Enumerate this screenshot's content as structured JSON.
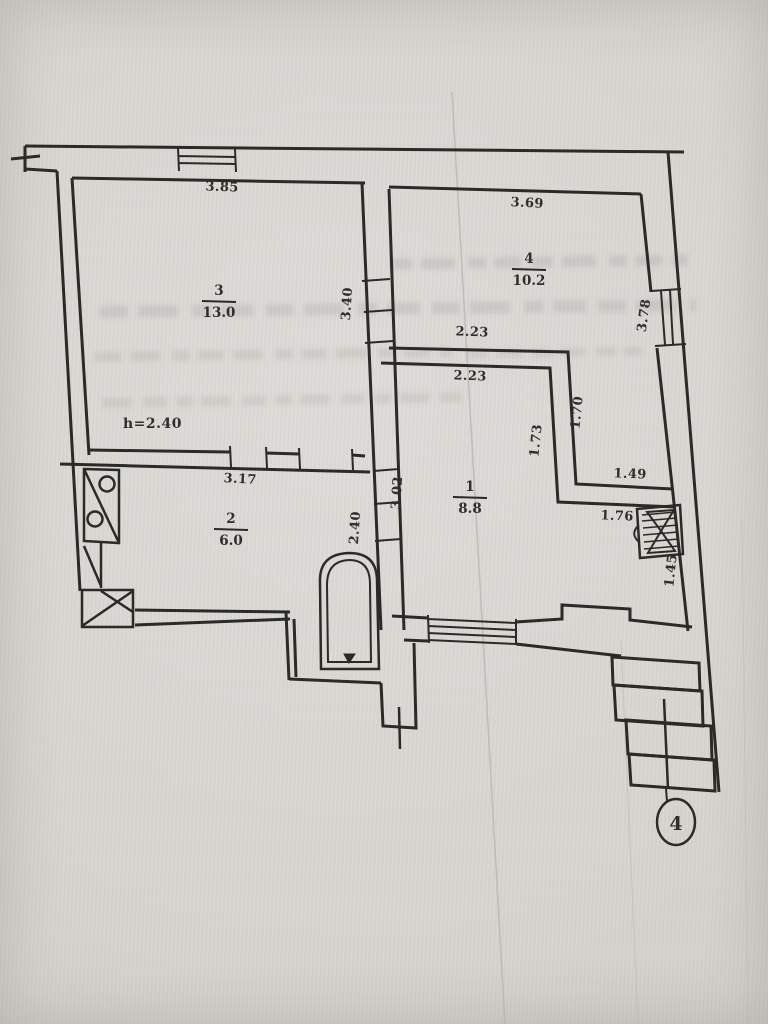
{
  "colors": {
    "paper": "#d8d5d0",
    "ink": "#2a2927",
    "ghost": "#75736e",
    "crease": "#b5b3ae"
  },
  "plan": {
    "rooms": [
      {
        "name": "room-3",
        "number": "3",
        "area": "13.0",
        "x": 219,
        "y": 295
      },
      {
        "name": "room-4",
        "number": "4",
        "area": "10.2",
        "x": 529,
        "y": 263
      },
      {
        "name": "room-1",
        "number": "1",
        "area": "8.8",
        "x": 470,
        "y": 491
      },
      {
        "name": "room-2",
        "number": "2",
        "area": "6.0",
        "x": 231,
        "y": 523
      }
    ],
    "dimensions": [
      {
        "text": "3.85",
        "x": 222,
        "y": 191,
        "rot": 2
      },
      {
        "text": "3.40",
        "x": 351,
        "y": 304,
        "rot": -86
      },
      {
        "text": "3.69",
        "x": 527,
        "y": 207,
        "rot": 3
      },
      {
        "text": "2.23",
        "x": 472,
        "y": 336,
        "rot": 2
      },
      {
        "text": "2.23",
        "x": 470,
        "y": 380,
        "rot": 2
      },
      {
        "text": "3.78",
        "x": 648,
        "y": 316,
        "rot": -82
      },
      {
        "text": "1.70",
        "x": 581,
        "y": 413,
        "rot": -84
      },
      {
        "text": "1.73",
        "x": 540,
        "y": 441,
        "rot": -84
      },
      {
        "text": "1.49",
        "x": 630,
        "y": 478,
        "rot": 2
      },
      {
        "text": "1.76",
        "x": 617,
        "y": 520,
        "rot": 2
      },
      {
        "text": "1.45",
        "x": 675,
        "y": 571,
        "rot": -84
      },
      {
        "text": "3.17",
        "x": 240,
        "y": 483,
        "rot": 3
      },
      {
        "text": "2.40",
        "x": 359,
        "y": 528,
        "rot": -86
      },
      {
        "text": "3.02",
        "x": 401,
        "y": 493,
        "rot": -86
      }
    ],
    "ceiling_height": {
      "text": "h=2.40",
      "x": 123,
      "y": 428
    },
    "floor_marker": {
      "text": "4",
      "x": 676,
      "y": 822
    }
  }
}
